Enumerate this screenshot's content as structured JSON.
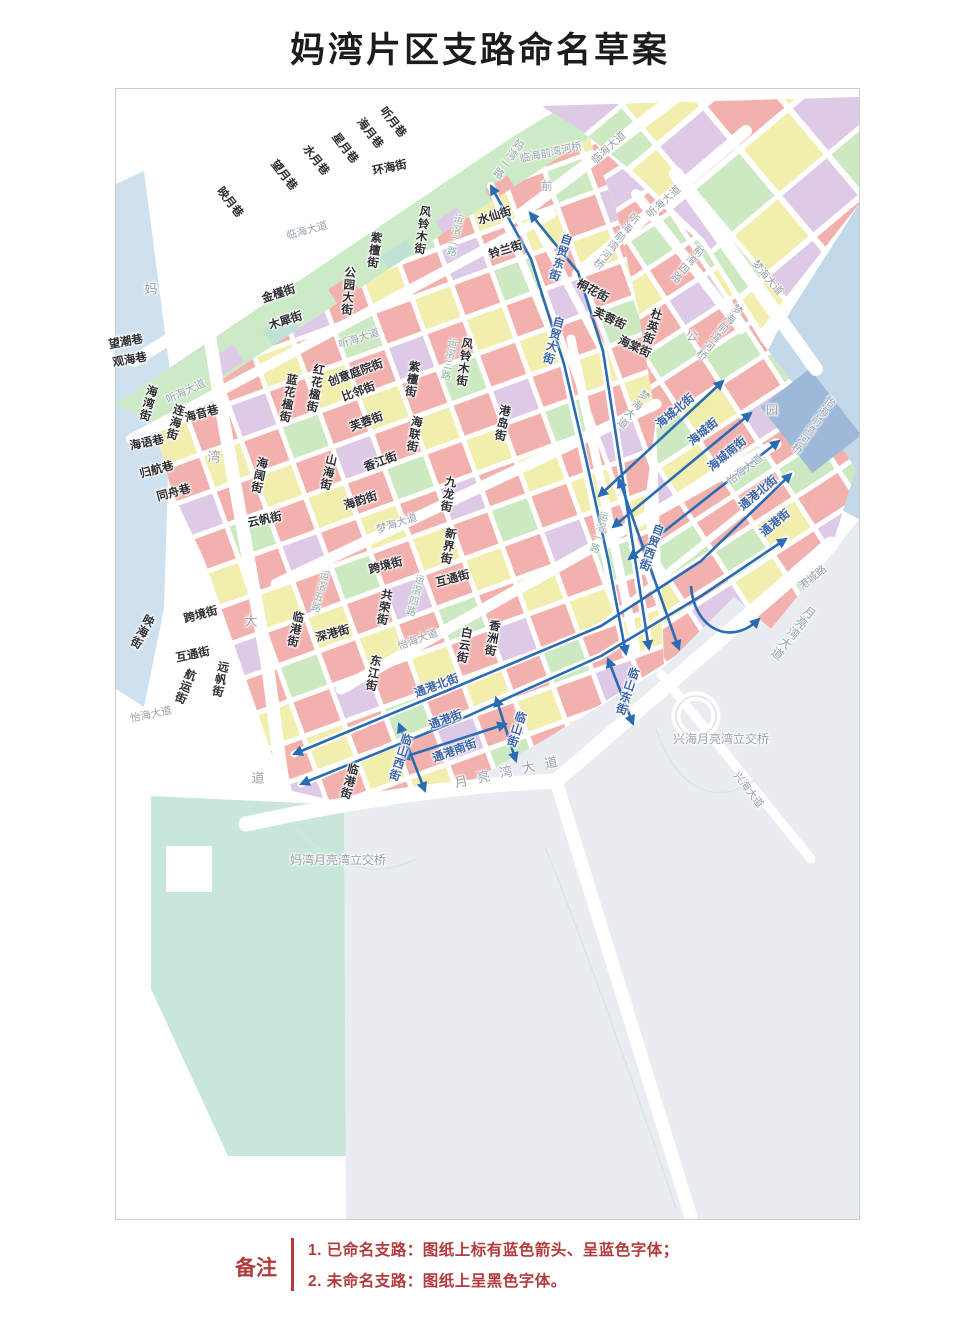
{
  "title": "妈湾片区支路命名草案",
  "colors": {
    "arrow_blue": "#2a6cb3",
    "named_street_text": "#3c64aa",
    "unnamed_street_text": "#2e2e33",
    "faint_road_text": "#98a2ab",
    "note_red": "#b23b3b",
    "block_pink": "#f3b1ae",
    "block_yellow": "#f2eeae",
    "block_green": "#cde9c2",
    "block_purple": "#dec9e7",
    "block_teal": "#c0e2d4",
    "water_blue": "#c3d9ea"
  },
  "legend": {
    "heading": "备注",
    "items": [
      "1. 已命名支路：图纸上标有蓝色箭头、呈蓝色字体；",
      "2. 未命名支路：图纸上呈黑色字体。"
    ]
  },
  "map": {
    "labels": [
      {
        "t": "映月巷",
        "x": 113,
        "y": 114,
        "r": 52,
        "c": "k"
      },
      {
        "t": "望月巷",
        "x": 167,
        "y": 87,
        "r": 52,
        "c": "k"
      },
      {
        "t": "水月巷",
        "x": 199,
        "y": 72,
        "r": 52,
        "c": "k"
      },
      {
        "t": "星月巷",
        "x": 228,
        "y": 60,
        "r": 52,
        "c": "k"
      },
      {
        "t": "海月巷",
        "x": 253,
        "y": 45,
        "r": 52,
        "c": "k"
      },
      {
        "t": "听月巷",
        "x": 276,
        "y": 34,
        "r": 52,
        "c": "k"
      },
      {
        "t": "环海街",
        "x": 274,
        "y": 80,
        "r": -12,
        "c": "k"
      },
      {
        "t": "临海大道",
        "x": 191,
        "y": 142,
        "r": -15,
        "c": "f"
      },
      {
        "t": "金槿街",
        "x": 163,
        "y": 206,
        "r": -18,
        "c": "k"
      },
      {
        "t": "木犀街",
        "x": 170,
        "y": 233,
        "r": -18,
        "c": "k"
      },
      {
        "t": "公园大街",
        "x": 231,
        "y": 202,
        "r": 5,
        "c": "k",
        "v": 1
      },
      {
        "t": "紫檀街",
        "x": 257,
        "y": 161,
        "r": 8,
        "c": "k",
        "v": 1
      },
      {
        "t": "风铃木街",
        "x": 305,
        "y": 141,
        "r": 8,
        "c": "k",
        "v": 1
      },
      {
        "t": "运滘二路",
        "x": 337,
        "y": 146,
        "r": 12,
        "c": "t",
        "v": 1
      },
      {
        "t": "水仙街",
        "x": 379,
        "y": 128,
        "r": -17,
        "c": "k"
      },
      {
        "t": "铃兰街",
        "x": 390,
        "y": 162,
        "r": -17,
        "c": "k"
      },
      {
        "t": "自贸东街",
        "x": 443,
        "y": 168,
        "r": 18,
        "c": "b",
        "v": 1
      },
      {
        "t": "自贸大街",
        "x": 436,
        "y": 251,
        "r": 15,
        "c": "b",
        "v": 1
      },
      {
        "t": "听海大道",
        "x": 243,
        "y": 250,
        "r": -18,
        "c": "f"
      },
      {
        "t": "望潮巷",
        "x": 10,
        "y": 254,
        "r": -10,
        "c": "k"
      },
      {
        "t": "观海巷",
        "x": 14,
        "y": 272,
        "r": -10,
        "c": "k"
      },
      {
        "t": "听海大道",
        "x": 70,
        "y": 303,
        "r": -25,
        "c": "f"
      },
      {
        "t": "海湾街",
        "x": 31,
        "y": 314,
        "r": 15,
        "c": "k",
        "v": 1
      },
      {
        "t": "连海街",
        "x": 58,
        "y": 333,
        "r": 15,
        "c": "k",
        "v": 1
      },
      {
        "t": "海音巷",
        "x": 86,
        "y": 326,
        "r": -15,
        "c": "k"
      },
      {
        "t": "海语巷",
        "x": 31,
        "y": 355,
        "r": -12,
        "c": "k"
      },
      {
        "t": "归航巷",
        "x": 41,
        "y": 382,
        "r": -15,
        "c": "k"
      },
      {
        "t": "同舟巷",
        "x": 58,
        "y": 405,
        "r": -15,
        "c": "k"
      },
      {
        "t": "蓝花楹街",
        "x": 171,
        "y": 309,
        "r": 10,
        "c": "k",
        "v": 1
      },
      {
        "t": "红花楹街",
        "x": 198,
        "y": 299,
        "r": 10,
        "c": "k",
        "v": 1
      },
      {
        "t": "创意庭院街",
        "x": 240,
        "y": 285,
        "r": -20,
        "c": "k"
      },
      {
        "t": "比邻街",
        "x": 243,
        "y": 304,
        "r": -20,
        "c": "k"
      },
      {
        "t": "紫檀街",
        "x": 295,
        "y": 290,
        "r": 8,
        "c": "k",
        "v": 1
      },
      {
        "t": "风铃木街",
        "x": 347,
        "y": 273,
        "r": 8,
        "c": "k",
        "v": 1
      },
      {
        "t": "运滘三路",
        "x": 331,
        "y": 270,
        "r": 12,
        "c": "t",
        "v": 1
      },
      {
        "t": "港岛街",
        "x": 385,
        "y": 334,
        "r": 10,
        "c": "k",
        "v": 1
      },
      {
        "t": "芙蓉街",
        "x": 251,
        "y": 334,
        "r": -20,
        "c": "k"
      },
      {
        "t": "海联街",
        "x": 297,
        "y": 345,
        "r": 10,
        "c": "k",
        "v": 1
      },
      {
        "t": "山海街",
        "x": 211,
        "y": 383,
        "r": 12,
        "c": "k",
        "v": 1
      },
      {
        "t": "香江街",
        "x": 265,
        "y": 374,
        "r": -20,
        "c": "k"
      },
      {
        "t": "九龙街",
        "x": 331,
        "y": 405,
        "r": 10,
        "c": "k",
        "v": 1
      },
      {
        "t": "海阔街",
        "x": 142,
        "y": 386,
        "r": 12,
        "c": "k",
        "v": 1
      },
      {
        "t": "云帆街",
        "x": 149,
        "y": 432,
        "r": -12,
        "c": "k"
      },
      {
        "t": "海韵街",
        "x": 245,
        "y": 413,
        "r": -18,
        "c": "k"
      },
      {
        "t": "梦海大道",
        "x": 281,
        "y": 435,
        "r": -18,
        "c": "f"
      },
      {
        "t": "新界街",
        "x": 331,
        "y": 457,
        "r": 10,
        "c": "k",
        "v": 1
      },
      {
        "t": "跨境街",
        "x": 270,
        "y": 478,
        "r": -15,
        "c": "k"
      },
      {
        "t": "互通街",
        "x": 337,
        "y": 491,
        "r": -15,
        "c": "k"
      },
      {
        "t": "共荣街",
        "x": 267,
        "y": 518,
        "r": 10,
        "c": "k",
        "v": 1
      },
      {
        "t": "运滘五路",
        "x": 202,
        "y": 502,
        "r": 15,
        "c": "t",
        "v": 1
      },
      {
        "t": "运滘四路",
        "x": 297,
        "y": 506,
        "r": 15,
        "c": "t",
        "v": 1
      },
      {
        "t": "运滘一路",
        "x": 481,
        "y": 443,
        "r": 15,
        "c": "t",
        "v": 1
      },
      {
        "t": "妈",
        "x": 35,
        "y": 200,
        "c": "f",
        "fs": 13
      },
      {
        "t": "湾",
        "x": 98,
        "y": 368,
        "c": "f",
        "fs": 13
      },
      {
        "t": "大",
        "x": 135,
        "y": 532,
        "c": "f",
        "fs": 13
      },
      {
        "t": "道",
        "x": 142,
        "y": 689,
        "c": "f",
        "fs": 13
      },
      {
        "t": "映海街",
        "x": 25,
        "y": 542,
        "r": 28,
        "c": "k",
        "v": 1
      },
      {
        "t": "跨境街",
        "x": 85,
        "y": 527,
        "r": -15,
        "c": "k"
      },
      {
        "t": "互通街",
        "x": 77,
        "y": 567,
        "r": -12,
        "c": "k"
      },
      {
        "t": "航运街",
        "x": 68,
        "y": 597,
        "r": 22,
        "c": "k",
        "v": 1
      },
      {
        "t": "远帆街",
        "x": 103,
        "y": 590,
        "r": 12,
        "c": "k",
        "v": 1
      },
      {
        "t": "怡海大道",
        "x": 35,
        "y": 626,
        "r": -12,
        "c": "f"
      },
      {
        "t": "临港街",
        "x": 178,
        "y": 540,
        "r": 12,
        "c": "k",
        "v": 1
      },
      {
        "t": "深港街",
        "x": 217,
        "y": 546,
        "r": -15,
        "c": "k"
      },
      {
        "t": "东江街",
        "x": 256,
        "y": 584,
        "r": 10,
        "c": "k",
        "v": 1
      },
      {
        "t": "临港街",
        "x": 232,
        "y": 692,
        "r": 15,
        "c": "k",
        "v": 1
      },
      {
        "t": "白云街",
        "x": 347,
        "y": 556,
        "r": 10,
        "c": "k",
        "v": 1
      },
      {
        "t": "香洲街",
        "x": 375,
        "y": 549,
        "r": 10,
        "c": "k",
        "v": 1
      },
      {
        "t": "怡海大道",
        "x": 302,
        "y": 551,
        "r": -20,
        "c": "f"
      },
      {
        "t": "通港北街",
        "x": 321,
        "y": 598,
        "r": -20,
        "c": "b"
      },
      {
        "t": "通港街",
        "x": 330,
        "y": 632,
        "r": -20,
        "c": "b"
      },
      {
        "t": "通港南街",
        "x": 339,
        "y": 663,
        "r": -20,
        "c": "b"
      },
      {
        "t": "临山西街",
        "x": 283,
        "y": 668,
        "r": 18,
        "c": "b",
        "v": 1
      },
      {
        "t": "临山街",
        "x": 399,
        "y": 640,
        "r": 18,
        "c": "b",
        "v": 1
      },
      {
        "t": "临山东街",
        "x": 510,
        "y": 602,
        "r": 18,
        "c": "b",
        "v": 1
      },
      {
        "t": "月亮湾大道",
        "x": 395,
        "y": 682,
        "r": -12,
        "c": "f",
        "fs": 13,
        "ls": 10
      },
      {
        "t": "桐花街",
        "x": 476,
        "y": 203,
        "r": 28,
        "c": "k"
      },
      {
        "t": "芙蓉街",
        "x": 493,
        "y": 231,
        "r": 25,
        "c": "k"
      },
      {
        "t": "杜英街",
        "x": 535,
        "y": 237,
        "r": 18,
        "c": "k",
        "v": 1
      },
      {
        "t": "海棠街",
        "x": 518,
        "y": 259,
        "r": 25,
        "c": "k"
      },
      {
        "t": "海城北街",
        "x": 560,
        "y": 323,
        "r": -40,
        "c": "b"
      },
      {
        "t": "海城街",
        "x": 588,
        "y": 344,
        "r": -40,
        "c": "b"
      },
      {
        "t": "海城南街",
        "x": 612,
        "y": 366,
        "r": -40,
        "c": "b"
      },
      {
        "t": "通港北街",
        "x": 643,
        "y": 405,
        "r": -40,
        "c": "b"
      },
      {
        "t": "通港街",
        "x": 660,
        "y": 435,
        "r": -40,
        "c": "b"
      },
      {
        "t": "自贸西街",
        "x": 534,
        "y": 458,
        "r": 20,
        "c": "b",
        "v": 1
      },
      {
        "t": "梦海大道",
        "x": 517,
        "y": 320,
        "r": 38,
        "c": "f",
        "v": 1
      },
      {
        "t": "怡海大道",
        "x": 629,
        "y": 381,
        "r": -38,
        "c": "f"
      },
      {
        "t": "临海前湾河桥",
        "x": 435,
        "y": 64,
        "r": -12,
        "c": "f"
      },
      {
        "t": "妈湾一路",
        "x": 392,
        "y": 70,
        "r": 35,
        "c": "f",
        "v": 1
      },
      {
        "t": "前",
        "x": 431,
        "y": 98,
        "c": "f",
        "fs": 11
      },
      {
        "t": "临海大道",
        "x": 493,
        "y": 59,
        "r": -42,
        "c": "f"
      },
      {
        "t": "听海大道",
        "x": 548,
        "y": 113,
        "r": -42,
        "c": "f"
      },
      {
        "t": "听海前湾河桥",
        "x": 500,
        "y": 152,
        "r": 38,
        "c": "f",
        "v": 1
      },
      {
        "t": "前湾四路",
        "x": 571,
        "y": 175,
        "r": 40,
        "c": "f",
        "v": 1
      },
      {
        "t": "梦海大道",
        "x": 651,
        "y": 189,
        "r": 50,
        "c": "f"
      },
      {
        "t": "梦海前湾河桥",
        "x": 603,
        "y": 243,
        "r": 38,
        "c": "f",
        "v": 1
      },
      {
        "t": "怡海前湾河桥",
        "x": 697,
        "y": 336,
        "r": 35,
        "c": "f",
        "v": 1
      },
      {
        "t": "公",
        "x": 576,
        "y": 247,
        "c": "f",
        "fs": 12
      },
      {
        "t": "园",
        "x": 656,
        "y": 321,
        "c": "f",
        "fs": 12
      },
      {
        "t": "港城路",
        "x": 697,
        "y": 489,
        "r": -38,
        "c": "f"
      },
      {
        "t": "月亮湾大道",
        "x": 677,
        "y": 544,
        "r": 38,
        "c": "f",
        "v": 1,
        "fs": 12
      },
      {
        "t": "兴海月亮湾立交桥",
        "x": 605,
        "y": 650,
        "c": "f",
        "fs": 12
      },
      {
        "t": "兴海大道",
        "x": 632,
        "y": 701,
        "r": 52,
        "c": "f"
      },
      {
        "t": "妈湾月亮湾立交桥",
        "x": 222,
        "y": 771,
        "c": "f",
        "fs": 12
      }
    ]
  }
}
